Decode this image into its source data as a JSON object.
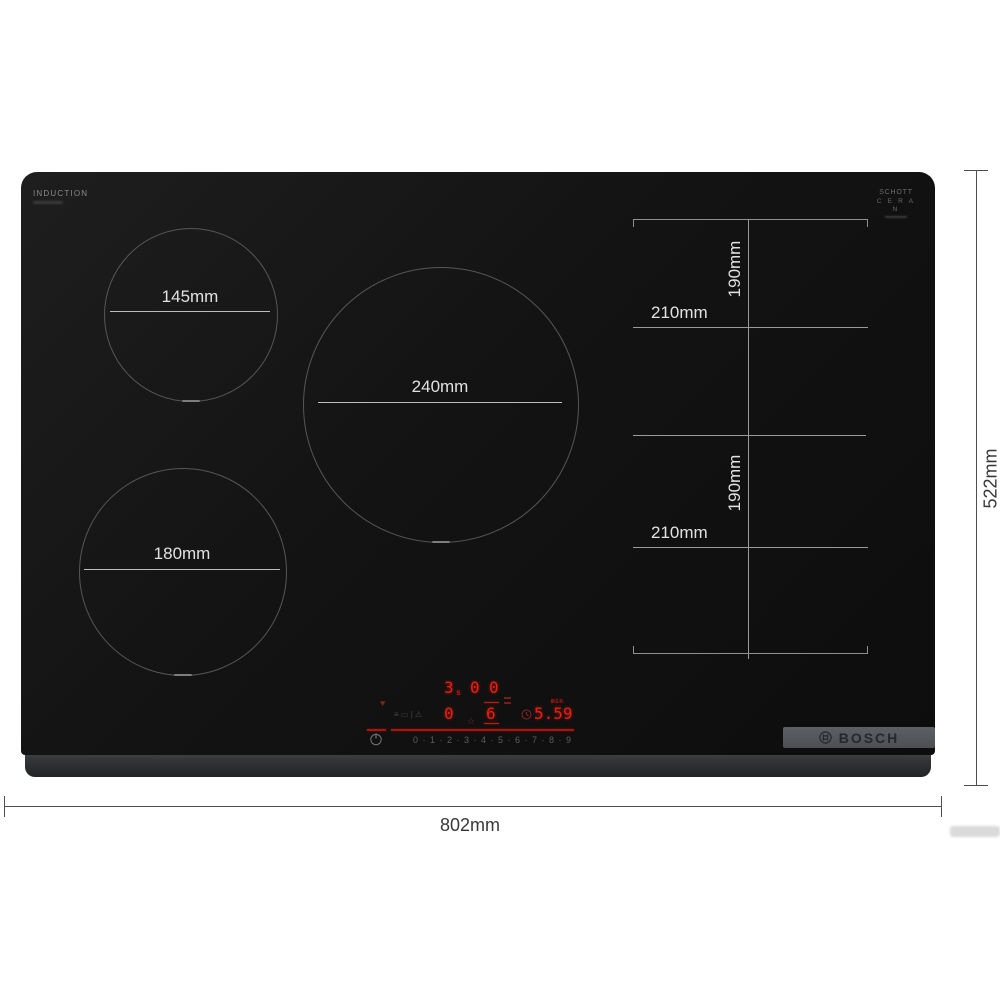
{
  "product": {
    "surface_label": "INDUCTION",
    "glass_brand": {
      "line1": "SCHOTT",
      "line2": "C E R A N"
    },
    "logo_text": "BOSCH"
  },
  "zones": {
    "small": {
      "label": "145mm"
    },
    "large": {
      "label": "240mm"
    },
    "medium": {
      "label": "180mm"
    },
    "flex_top": {
      "width_label": "210mm",
      "height_label": "190mm"
    },
    "flex_bottom": {
      "width_label": "210mm",
      "height_label": "190mm"
    }
  },
  "overall_dimensions": {
    "width_label": "802mm",
    "height_label": "522mm"
  },
  "control_panel": {
    "display": {
      "zone_power_1": "3",
      "zone_power_1_sub": "s",
      "zone_power_2": "0",
      "zone_power_3": "0",
      "zone_power_4": "0",
      "zone_power_5": "6",
      "timer_value": "5.59",
      "timer_unit": "min",
      "star_glyph": "☆",
      "heart_glyph": "♥"
    },
    "status_icons": {
      "icon1": "≡",
      "icon2": "▭",
      "icon3": "|",
      "icon4": "⚠"
    },
    "power_slider": {
      "levels": "0 · 1 · 2 · 3 · 4 · 5 · 6 · 7 · 8 · 9"
    }
  },
  "colors": {
    "hob_black": "#131313",
    "trim_gray": "#333437",
    "logo_strip_gray": "#54575b",
    "led_red": "#f21b0e",
    "slider_red": "#ad120b",
    "dimension_gray": "#4f4f4f"
  }
}
